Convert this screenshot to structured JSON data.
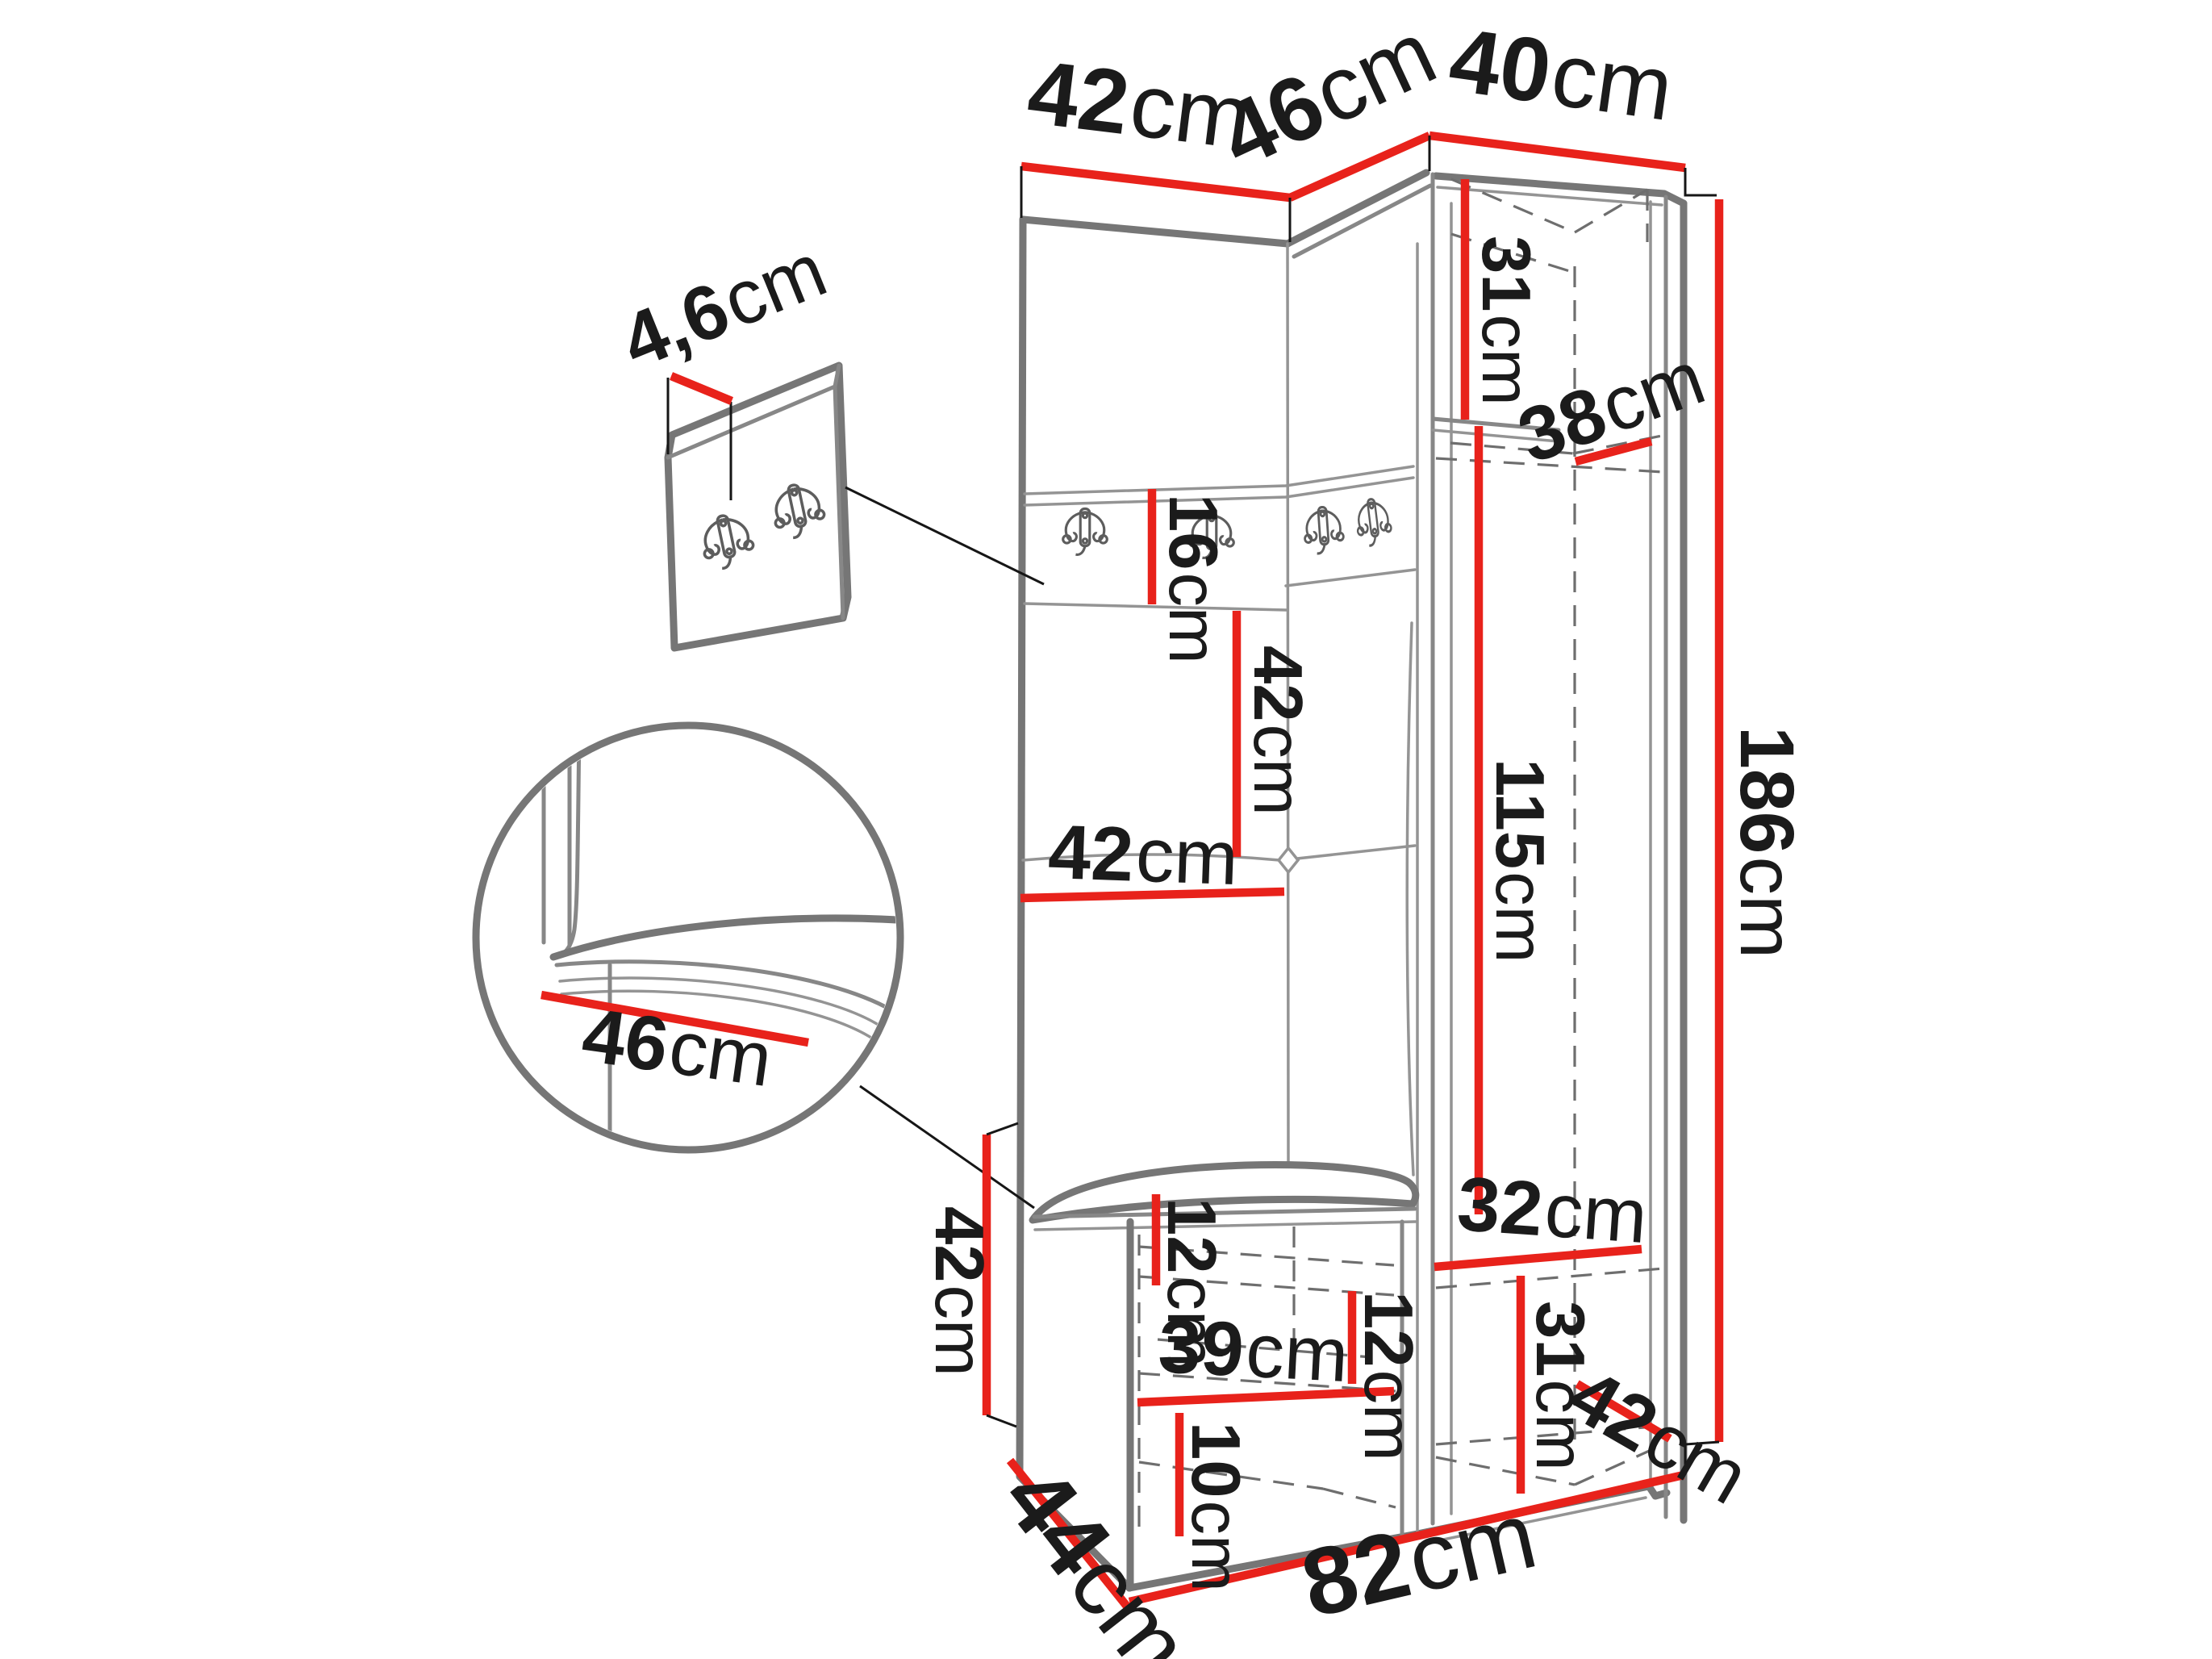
{
  "diagram": {
    "kind": "furniture-dimension-diagram",
    "product": "corner hallway wardrobe with hook panel, bench and tall cabinet",
    "accent_color": "#e8221b",
    "line_color": "#7a7a7a",
    "unit": "cm"
  },
  "icons": {
    "coat_hook": "double-coat-hook",
    "tufting_button": "diamond-button"
  },
  "dimensions": {
    "top_width_left": {
      "value": "42",
      "unit": "cm"
    },
    "top_width_middle": {
      "value": "46",
      "unit": "cm"
    },
    "top_width_right": {
      "value": "40",
      "unit": "cm"
    },
    "upper_compartment_h": {
      "value": "31",
      "unit": "cm"
    },
    "upper_shelf_depth": {
      "value": "38",
      "unit": "cm"
    },
    "total_height": {
      "value": "186",
      "unit": "cm"
    },
    "hook_panel_thickness": {
      "value": "4,6",
      "unit": "cm"
    },
    "hook_strip_height": {
      "value": "16",
      "unit": "cm"
    },
    "back_panel_height": {
      "value": "42",
      "unit": "cm"
    },
    "back_panel_width": {
      "value": "42",
      "unit": "cm"
    },
    "wardrobe_inner_height": {
      "value": "115",
      "unit": "cm"
    },
    "seat_detail_depth": {
      "value": "46",
      "unit": "cm"
    },
    "bench_height": {
      "value": "42",
      "unit": "cm"
    },
    "bench_top_clearance": {
      "value": "12",
      "unit": "cm"
    },
    "bench_mid_clearance": {
      "value": "12",
      "unit": "cm"
    },
    "bench_inner_width": {
      "value": "39",
      "unit": "cm"
    },
    "bench_bottom_clearance": {
      "value": "10",
      "unit": "cm"
    },
    "lower_compartment_w": {
      "value": "32",
      "unit": "cm"
    },
    "lower_compartment_h": {
      "value": "31",
      "unit": "cm"
    },
    "lower_compartment_d": {
      "value": "42",
      "unit": "cm"
    },
    "bench_depth": {
      "value": "44",
      "unit": "cm"
    },
    "total_width": {
      "value": "82",
      "unit": "cm"
    }
  }
}
